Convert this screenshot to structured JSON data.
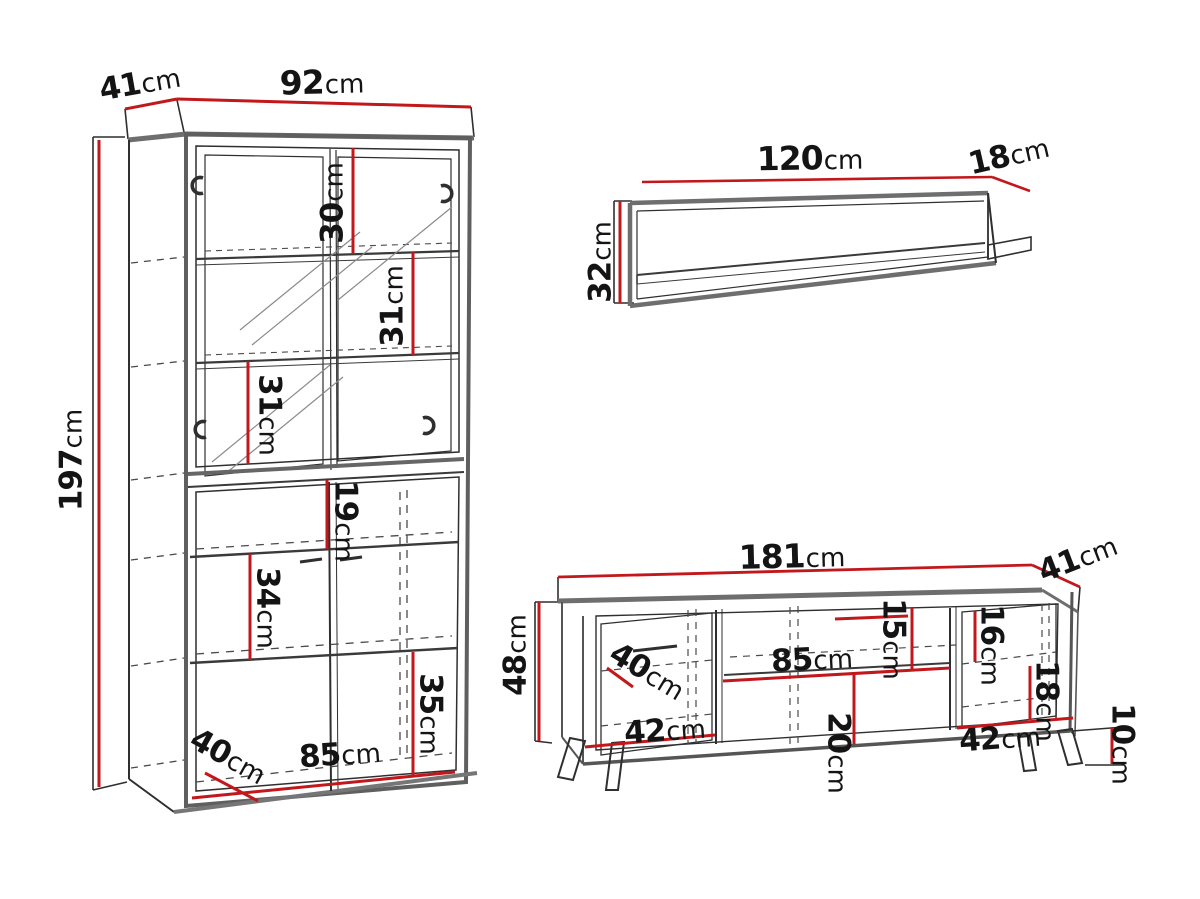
{
  "unit": "cm",
  "colors": {
    "dimension_line": "#c2181c",
    "outline_dark": "#2f2f2f",
    "outline_gray": "#6e6e6e"
  },
  "pieces": {
    "cabinet": {
      "height": "197",
      "width": "92",
      "depth": "41",
      "gap_top": "30",
      "gap_second": "31",
      "gap_third": "31",
      "gap_fourth": "19",
      "gap_fifth": "34",
      "gap_sixth": "35",
      "inner_depth": "40",
      "inner_width": "85"
    },
    "wall_shelf": {
      "width": "120",
      "depth": "18",
      "height": "32"
    },
    "tv_stand": {
      "width": "181",
      "depth": "41",
      "height": "48",
      "left_door_depth": "40",
      "left_door_width": "42",
      "shelf_width": "85",
      "gap_above_shelf": "15",
      "gap_below_shelf": "20",
      "right_gap_top": "16",
      "right_gap_bottom": "18",
      "right_door_width": "42",
      "leg_height": "10"
    }
  }
}
